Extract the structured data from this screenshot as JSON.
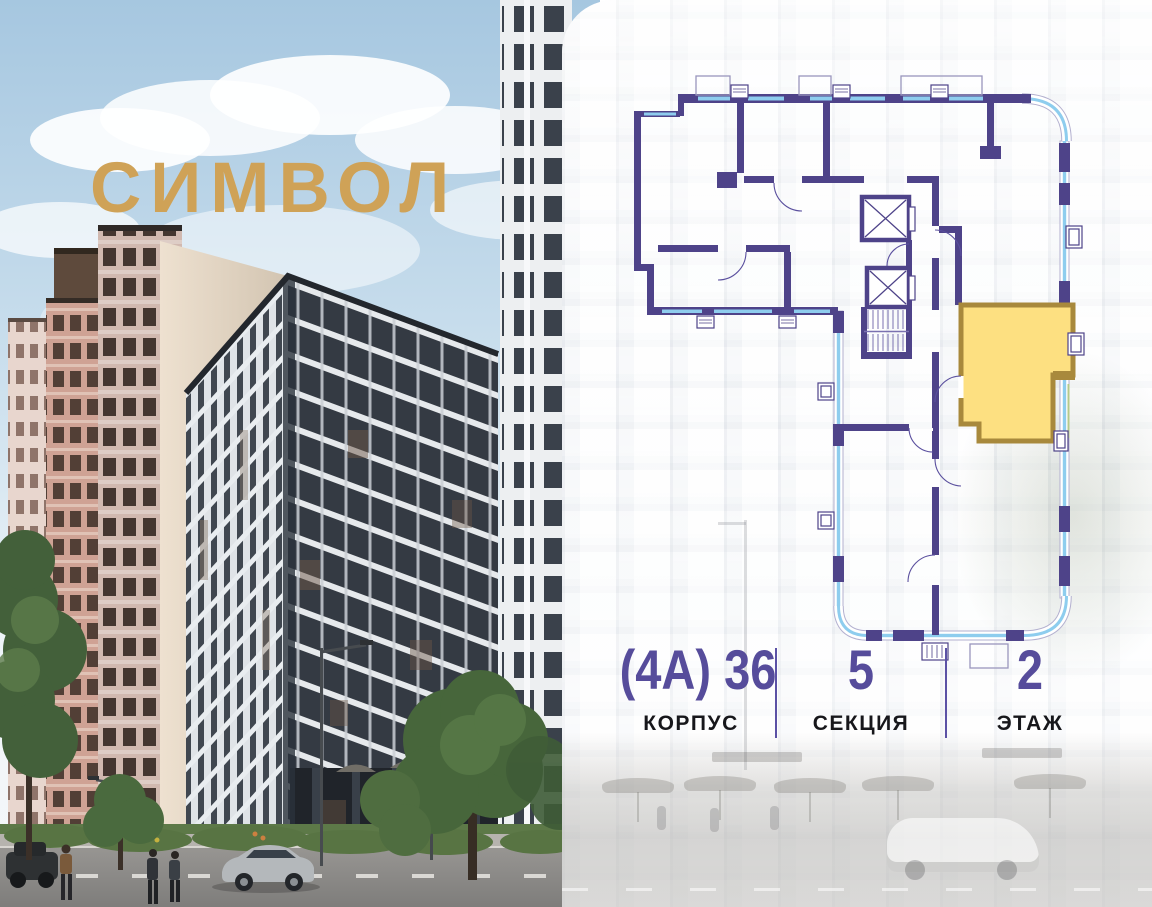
{
  "brand": {
    "title": "СИМВОЛ",
    "color": "#cfa257"
  },
  "palette": {
    "accent_purple": "#564c9b",
    "plan_wall": "#4e4389",
    "plan_glass": "#8ecdee",
    "highlight_fill": "#fde081",
    "highlight_border": "#a8893c"
  },
  "floor_plan": {
    "highlighted_apartment": "selected unit, section 5, floor 2"
  },
  "details": {
    "corpus": {
      "value": "(4А) 36",
      "label": "КОРПУС"
    },
    "section": {
      "value": "5",
      "label": "СЕКЦИЯ"
    },
    "floor": {
      "value": "2",
      "label": "ЭТАЖ"
    }
  }
}
